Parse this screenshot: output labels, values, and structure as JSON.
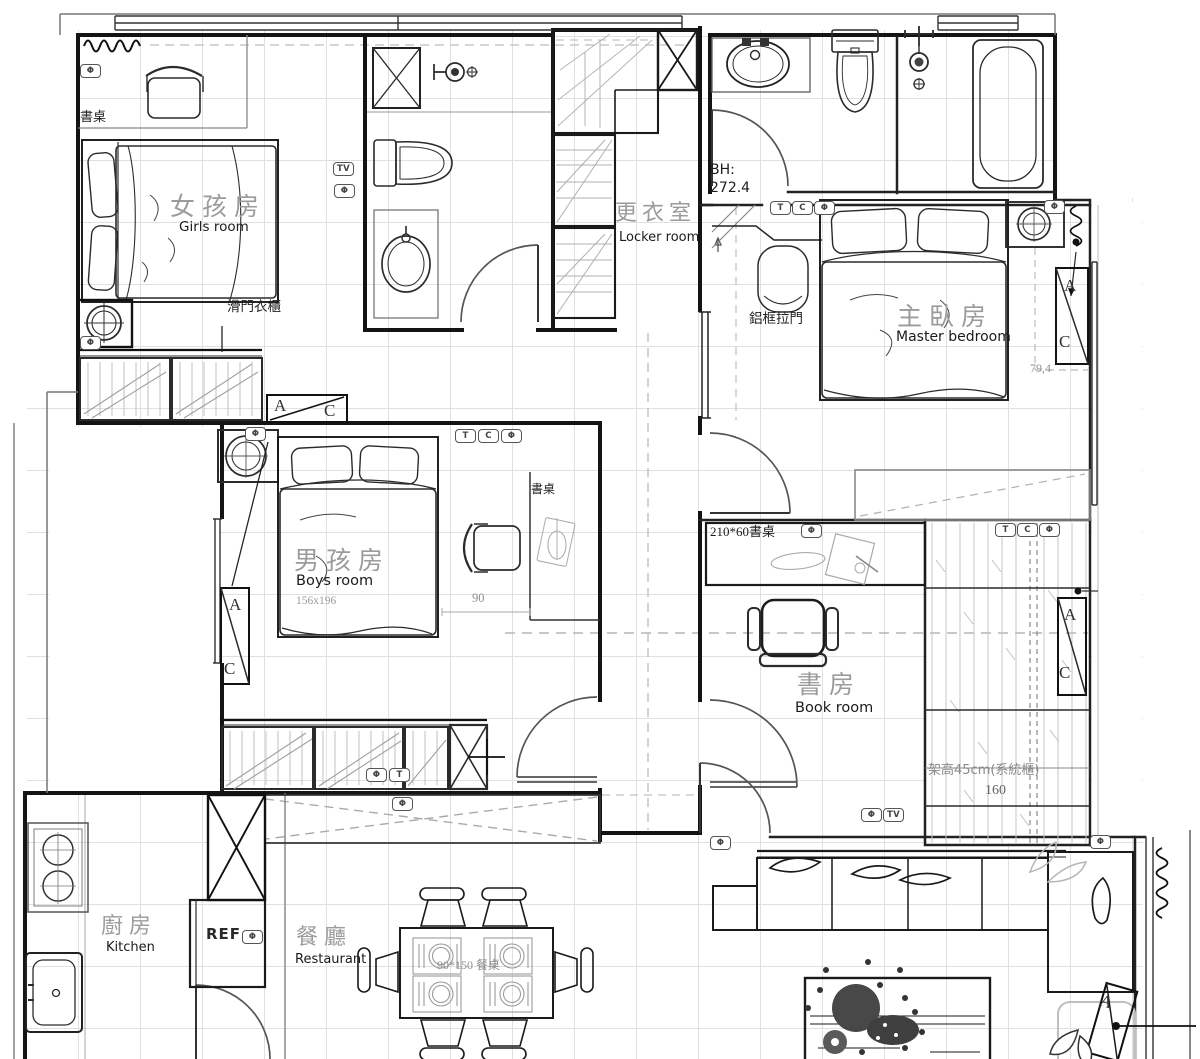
{
  "plan": {
    "rooms": {
      "girls": {
        "zh": "女孩房",
        "en": "Girls room"
      },
      "locker": {
        "zh": "更衣室",
        "en": "Locker room"
      },
      "master": {
        "zh": "主臥房",
        "en": "Master bedroom"
      },
      "boys": {
        "zh": "男孩房",
        "en": "Boys room",
        "bed_size": "156x196"
      },
      "book": {
        "zh": "書房",
        "en": "Book room"
      },
      "kitchen": {
        "zh": "廚房",
        "en": "Kitchen"
      },
      "dining": {
        "zh": "餐廳",
        "en": "Restaurant"
      }
    },
    "labels": {
      "desk": "書桌",
      "sliding_wardrobe": "滑門衣櫃",
      "aluminum_sliding_door": "鋁框拉門",
      "bh_prefix": "BH:",
      "bh_value": "272.4",
      "book_desk": "210*60書桌",
      "platform": "架高45cm(系統櫃)",
      "dining_table": "90*150 餐桌",
      "fridge": "REF"
    },
    "dimensions": {
      "master_side": "79,4",
      "boys_desk": "90",
      "platform_width": "160"
    },
    "chips": {
      "tv": "TV",
      "t": "T",
      "c": "C",
      "outlet": "Φ"
    },
    "ac": {
      "a": "A",
      "c": "C"
    },
    "colors": {
      "wall": "#141414",
      "furniture": "#2b2b2b",
      "gray": "#9c9c9c",
      "grid": "#dcdcdc",
      "room_label": "#9b9b9b"
    }
  }
}
